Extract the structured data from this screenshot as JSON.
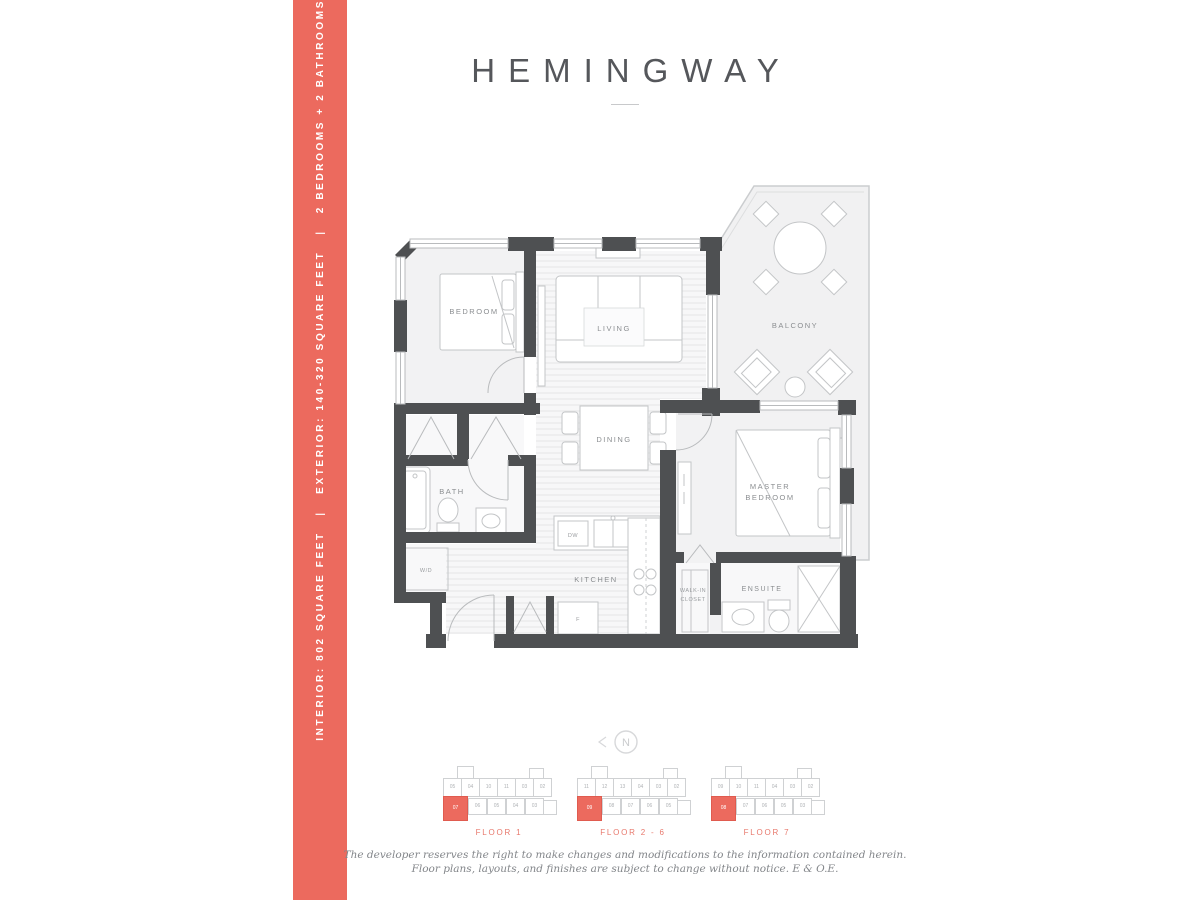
{
  "page": {
    "title": "HEMINGWAY",
    "accent_color": "#ec6a5e",
    "disclaimer_line1": "The developer reserves the right to make changes and modifications to the information contained herein.",
    "disclaimer_line2": "Floor plans, layouts, and finishes are subject to change without notice. E & O.E."
  },
  "sidebar": {
    "interior": "INTERIOR: 802 SQUARE FEET",
    "separator": "|",
    "exterior": "EXTERIOR: 140-320 SQUARE FEET",
    "config": "2 BEDROOMS + 2 BATHROOMS"
  },
  "floor_plan": {
    "labels": {
      "bedroom": "BEDROOM",
      "living": "LIVING",
      "balcony": "BALCONY",
      "dining": "DINING",
      "bath": "BATH",
      "kitchen": "KITCHEN",
      "master_line1": "MASTER",
      "master_line2": "BEDROOM",
      "wic_line1": "WALK-IN",
      "wic_line2": "CLOSET",
      "ensuite": "ENSUITE",
      "washer_dryer": "W/D",
      "dishwasher": "DW",
      "fridge": "F"
    }
  },
  "compass": {
    "label": "N"
  },
  "keyplans": [
    {
      "label": "FLOOR 1",
      "units": [
        {
          "n": "",
          "x": 16,
          "y": 0,
          "w": 15,
          "h": 12,
          "hl": false
        },
        {
          "n": "",
          "x": 88,
          "y": 2,
          "w": 13,
          "h": 10,
          "hl": false
        },
        {
          "n": "05",
          "x": 2,
          "y": 12,
          "w": 17,
          "h": 17,
          "hl": false
        },
        {
          "n": "04",
          "x": 20,
          "y": 12,
          "w": 17,
          "h": 17,
          "hl": false
        },
        {
          "n": "10",
          "x": 38,
          "y": 12,
          "w": 17,
          "h": 17,
          "hl": false
        },
        {
          "n": "11",
          "x": 56,
          "y": 12,
          "w": 17,
          "h": 17,
          "hl": false
        },
        {
          "n": "03",
          "x": 74,
          "y": 12,
          "w": 17,
          "h": 17,
          "hl": false
        },
        {
          "n": "02",
          "x": 92,
          "y": 12,
          "w": 17,
          "h": 17,
          "hl": false
        },
        {
          "n": "07",
          "x": 2,
          "y": 30,
          "w": 23,
          "h": 23,
          "hl": true
        },
        {
          "n": "06",
          "x": 27,
          "y": 32,
          "w": 17,
          "h": 15,
          "hl": false
        },
        {
          "n": "05",
          "x": 46,
          "y": 32,
          "w": 17,
          "h": 15,
          "hl": false
        },
        {
          "n": "04",
          "x": 65,
          "y": 32,
          "w": 17,
          "h": 15,
          "hl": false
        },
        {
          "n": "03",
          "x": 84,
          "y": 32,
          "w": 17,
          "h": 15,
          "hl": false
        },
        {
          "n": "",
          "x": 102,
          "y": 34,
          "w": 12,
          "h": 13,
          "hl": false
        }
      ]
    },
    {
      "label": "FLOOR 2 - 6",
      "units": [
        {
          "n": "",
          "x": 16,
          "y": 0,
          "w": 15,
          "h": 12,
          "hl": false
        },
        {
          "n": "",
          "x": 88,
          "y": 2,
          "w": 13,
          "h": 10,
          "hl": false
        },
        {
          "n": "11",
          "x": 2,
          "y": 12,
          "w": 17,
          "h": 17,
          "hl": false
        },
        {
          "n": "12",
          "x": 20,
          "y": 12,
          "w": 17,
          "h": 17,
          "hl": false
        },
        {
          "n": "13",
          "x": 38,
          "y": 12,
          "w": 17,
          "h": 17,
          "hl": false
        },
        {
          "n": "04",
          "x": 56,
          "y": 12,
          "w": 17,
          "h": 17,
          "hl": false
        },
        {
          "n": "03",
          "x": 74,
          "y": 12,
          "w": 17,
          "h": 17,
          "hl": false
        },
        {
          "n": "02",
          "x": 92,
          "y": 12,
          "w": 17,
          "h": 17,
          "hl": false
        },
        {
          "n": "09",
          "x": 2,
          "y": 30,
          "w": 23,
          "h": 23,
          "hl": true
        },
        {
          "n": "08",
          "x": 27,
          "y": 32,
          "w": 17,
          "h": 15,
          "hl": false
        },
        {
          "n": "07",
          "x": 46,
          "y": 32,
          "w": 17,
          "h": 15,
          "hl": false
        },
        {
          "n": "06",
          "x": 65,
          "y": 32,
          "w": 17,
          "h": 15,
          "hl": false
        },
        {
          "n": "05",
          "x": 84,
          "y": 32,
          "w": 17,
          "h": 15,
          "hl": false
        },
        {
          "n": "",
          "x": 102,
          "y": 34,
          "w": 12,
          "h": 13,
          "hl": false
        }
      ]
    },
    {
      "label": "FLOOR 7",
      "units": [
        {
          "n": "",
          "x": 16,
          "y": 0,
          "w": 15,
          "h": 12,
          "hl": false
        },
        {
          "n": "",
          "x": 88,
          "y": 2,
          "w": 13,
          "h": 10,
          "hl": false
        },
        {
          "n": "09",
          "x": 2,
          "y": 12,
          "w": 17,
          "h": 17,
          "hl": false
        },
        {
          "n": "10",
          "x": 20,
          "y": 12,
          "w": 17,
          "h": 17,
          "hl": false
        },
        {
          "n": "11",
          "x": 38,
          "y": 12,
          "w": 17,
          "h": 17,
          "hl": false
        },
        {
          "n": "04",
          "x": 56,
          "y": 12,
          "w": 17,
          "h": 17,
          "hl": false
        },
        {
          "n": "03",
          "x": 74,
          "y": 12,
          "w": 17,
          "h": 17,
          "hl": false
        },
        {
          "n": "02",
          "x": 92,
          "y": 12,
          "w": 17,
          "h": 17,
          "hl": false
        },
        {
          "n": "08",
          "x": 2,
          "y": 30,
          "w": 23,
          "h": 23,
          "hl": true
        },
        {
          "n": "07",
          "x": 27,
          "y": 32,
          "w": 17,
          "h": 15,
          "hl": false
        },
        {
          "n": "06",
          "x": 46,
          "y": 32,
          "w": 17,
          "h": 15,
          "hl": false
        },
        {
          "n": "05",
          "x": 65,
          "y": 32,
          "w": 17,
          "h": 15,
          "hl": false
        },
        {
          "n": "03",
          "x": 84,
          "y": 32,
          "w": 17,
          "h": 15,
          "hl": false
        },
        {
          "n": "",
          "x": 102,
          "y": 34,
          "w": 12,
          "h": 13,
          "hl": false
        }
      ]
    }
  ]
}
